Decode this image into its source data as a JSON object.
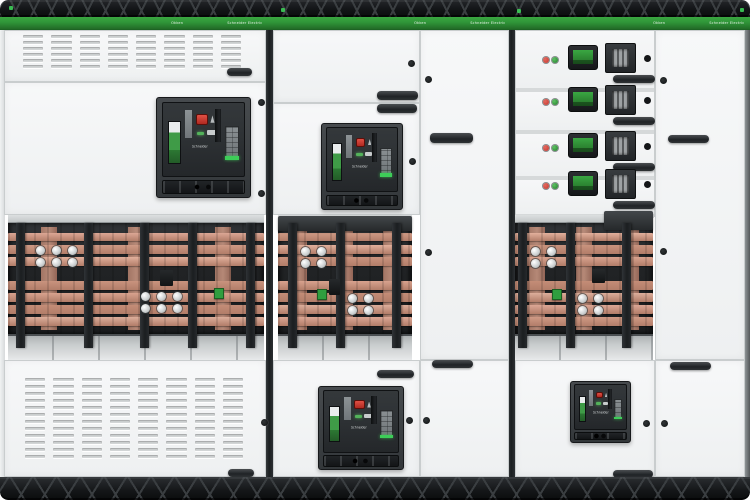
{
  "scene": {
    "description": "Product photograph of a three-section low-voltage switchboard lineup with withdrawable air circuit breakers, motor-control drawer units, ventilated covers and an exposed copper busbar compartment",
    "background": "#ffffff"
  },
  "brand": {
    "product": "Okken",
    "logo": "Schneider Electric",
    "breaker_label": "Schneider"
  },
  "palette": {
    "truss_dark": "#131517",
    "truss_strut": "#3a3e41",
    "band_green": "#2f9538",
    "band_green_dark": "#1d6423",
    "panel_white": "#f5f6f7",
    "seam_gray": "#c9cdce",
    "cavity_dark": "#222426",
    "copper": "#d39d89",
    "support_dark": "#212427",
    "tray_gray": "#c8cccd",
    "breaker_face": "#2e3235",
    "indicator_red": "#c6352c",
    "indicator_green": "#2f9e3f",
    "accent_green": "#3dcd58",
    "handle_dark": "#26292c"
  },
  "structure": {
    "columns": 3,
    "busbar_bays": 3,
    "copper_rows_per_bay": 7,
    "circuit_breakers": 4,
    "vent_panels": 2,
    "drawer_units": 4
  },
  "drawers": [
    {
      "id": "drawer-unit-1",
      "indicators": [
        "red",
        "green"
      ],
      "has_rotary_switch": true,
      "has_meter_display": true,
      "has_knob": true,
      "has_handle": true
    },
    {
      "id": "drawer-unit-2",
      "indicators": [
        "red",
        "green"
      ],
      "has_rotary_switch": true,
      "has_meter_display": true,
      "has_knob": true,
      "has_handle": true
    },
    {
      "id": "drawer-unit-3",
      "indicators": [
        "red",
        "green"
      ],
      "has_rotary_switch": true,
      "has_meter_display": true,
      "has_knob": true,
      "has_handle": true
    },
    {
      "id": "drawer-unit-4",
      "indicators": [
        "red",
        "green"
      ],
      "has_rotary_switch": true,
      "has_meter_display": true,
      "has_knob": true,
      "has_handle": true
    }
  ]
}
